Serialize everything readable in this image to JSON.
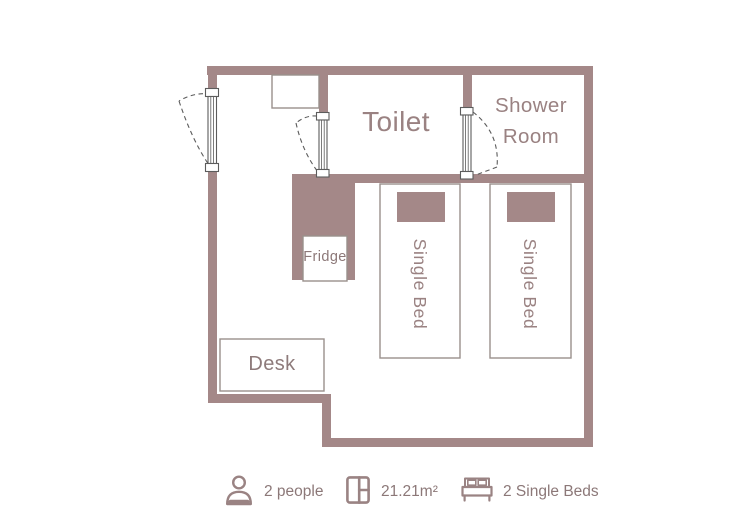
{
  "plan": {
    "labels": {
      "toilet": "Toilet",
      "shower_room": "Shower Room",
      "fridge": "Fridge",
      "desk": "Desk",
      "single_bed_1": "Single Bed",
      "single_bed_2": "Single Bed"
    }
  },
  "footer": {
    "items": [
      {
        "icon": "person-icon",
        "label": "2 people"
      },
      {
        "icon": "floorplan-icon",
        "label": "21.21m²"
      },
      {
        "icon": "bed-icon",
        "label": "2 Single Beds"
      }
    ]
  },
  "colors": {
    "wall": "#A48888",
    "label": "#9A8282",
    "footer-text": "#8C7878",
    "outline": "#99908B",
    "door-line": "#5C5C5C",
    "icon": "#9A8383"
  }
}
